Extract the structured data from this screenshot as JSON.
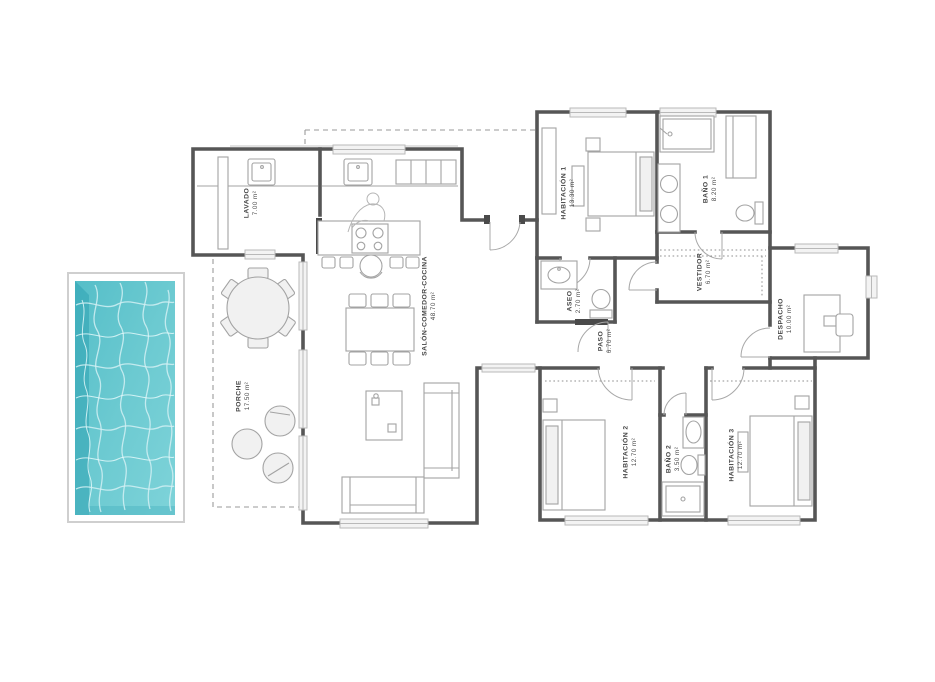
{
  "document": {
    "type": "floor-plan",
    "style": "architectural plan with pool"
  },
  "rooms": {
    "lavado": {
      "name": "LAVADO",
      "area": "7.00 m²"
    },
    "porche": {
      "name": "PORCHE",
      "area": "17.50 m²"
    },
    "salon": {
      "name": "SALÓN-COMEDOR-COCINA",
      "area": "48.70 m²"
    },
    "habitacion1": {
      "name": "HABITACIÓN 1",
      "area": "13.30 m²"
    },
    "bano1": {
      "name": "BAÑO 1",
      "area": "8.20 m²"
    },
    "aseo": {
      "name": "ASEO",
      "area": "2.70 m²"
    },
    "vestidor": {
      "name": "VESTIDOR",
      "area": "6.70 m²"
    },
    "paso": {
      "name": "PASO",
      "area": "6.70 m²"
    },
    "despacho": {
      "name": "DESPACHO",
      "area": "10.00 m²"
    },
    "habitacion2": {
      "name": "HABITACIÓN 2",
      "area": "12.70 m²"
    },
    "bano2": {
      "name": "BAÑO 2",
      "area": "3.50 m²"
    },
    "habitacion3": {
      "name": "HABITACIÓN 3",
      "area": "12.70 m²"
    }
  },
  "colors": {
    "wall": "#565656",
    "furniture": "#a3a3a3",
    "label": "#464646",
    "pool_water_light": "#82d5da",
    "pool_water": "#57c0c9",
    "pool_water_dark": "#2fa3b2"
  }
}
